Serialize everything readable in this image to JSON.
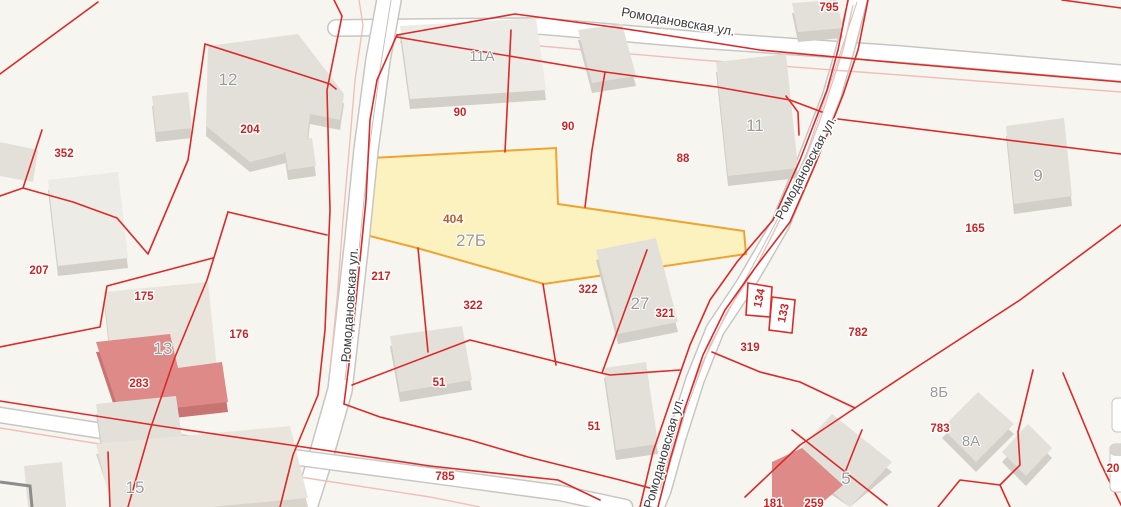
{
  "map": {
    "street_name": "Ромодановская ул.",
    "street_labels": {
      "top": "Ромодановская ул.",
      "left_road": "Ромодановская ул.",
      "right_road": "Ромодановская ул.",
      "bottom_road": "Ромодановская ул."
    },
    "selected_parcel": {
      "number": "404",
      "building": "27Б"
    },
    "parcel_labels": {
      "p795": "795",
      "p204": "204",
      "p90a": "90",
      "p90b": "90",
      "p88": "88",
      "p165": "165",
      "p352": "352",
      "p207": "207",
      "p175": "175",
      "p176": "176",
      "p283": "283",
      "p217": "217",
      "p404": "404",
      "p322a": "322",
      "p322b": "322",
      "p321": "321",
      "p319": "319",
      "p134": "134",
      "p133": "133",
      "p782": "782",
      "p783": "783",
      "p181": "181",
      "p259": "259",
      "p51a": "51",
      "p51b": "51",
      "p785": "785",
      "p20": "20"
    },
    "building_labels": {
      "b12": "12",
      "b11a": "11А",
      "b11": "11",
      "b9": "9",
      "b13": "13",
      "b15": "15",
      "b27": "27",
      "b27b": "27Б",
      "b8a": "8А",
      "b8b": "8Б",
      "b5": "5"
    },
    "colors": {
      "background": "#f7f5f0",
      "parcel_line": "#dc2a28",
      "faded_line": "#f1bfba",
      "selected_fill": "#fbf2c0",
      "selected_stroke": "#f0a32f",
      "building_fill": "#e3e0da",
      "building_pink": "#dd8a88",
      "label_red": "#cc2424",
      "label_gray": "#9a9a98",
      "street_text": "#3c3c3c"
    }
  }
}
